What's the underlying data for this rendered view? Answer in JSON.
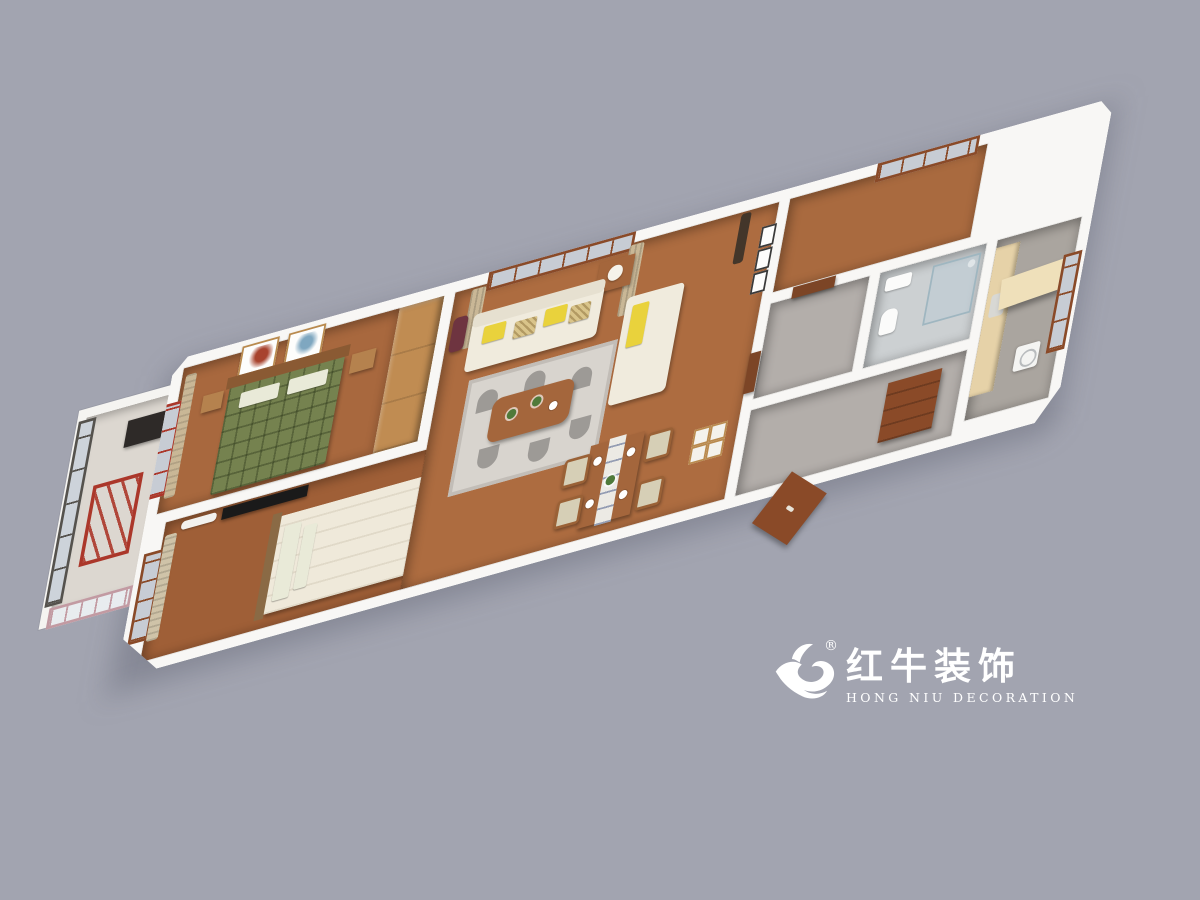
{
  "page": {
    "background_color": "#a2a4b0"
  },
  "logo": {
    "registered_mark": "®",
    "brand_cn": "红牛装饰",
    "brand_en": "HONG NIU DECORATION",
    "color": "#ffffff",
    "icon": "bull-logo-icon"
  },
  "scene": {
    "type": "3d-apartment-floorplan-render",
    "wall_color": "#f8f7f5",
    "rooms": [
      {
        "name": "balcony",
        "floor_color": "#dcd7d0",
        "features": [
          "dark-framed-windows",
          "red-drying-rack",
          "pink-framed-window"
        ]
      },
      {
        "name": "bedroom-green",
        "floor_color": "#a8683e",
        "features": [
          "green-plaid-double-bed",
          "two-wall-art-frames",
          "nightstands",
          "wood-wardrobe",
          "red-framed-window"
        ]
      },
      {
        "name": "bedroom-white",
        "floor_color": "#9f5f37",
        "features": [
          "cream-double-bed",
          "wall-tv",
          "air-conditioner",
          "olive-wardrobe",
          "window-with-striped-curtains"
        ]
      },
      {
        "name": "living-room",
        "floor_color": "#ad6c40",
        "features": [
          "cream-sofa-set",
          "yellow-pillows",
          "gray-patterned-rug",
          "wood-coffee-table",
          "side-table-lamp",
          "window-with-tan-curtains",
          "wall-frames"
        ]
      },
      {
        "name": "dining-area",
        "floor_color": "#ad6c40",
        "features": [
          "wood-dining-table",
          "four-chairs",
          "table-runner",
          "four-picture-frames"
        ]
      },
      {
        "name": "study-room",
        "floor_color": "#a96a3f",
        "features": [
          "empty",
          "window"
        ]
      },
      {
        "name": "hallway",
        "floor_color": "#b3aeaa",
        "features": [
          "brown-doors"
        ]
      },
      {
        "name": "bathroom",
        "floor_color": "#ccd0d2",
        "features": [
          "glass-shower",
          "sink",
          "toilet",
          "white-tile"
        ]
      },
      {
        "name": "kitchen",
        "floor_color": "#aaa59f",
        "features": [
          "light-wood-cabinets",
          "washing-machine",
          "large-window"
        ]
      },
      {
        "name": "entry-hall",
        "floor_color": "#b3aeaa",
        "features": [
          "brown-shoe-cabinet",
          "open-entry-door"
        ]
      }
    ]
  }
}
